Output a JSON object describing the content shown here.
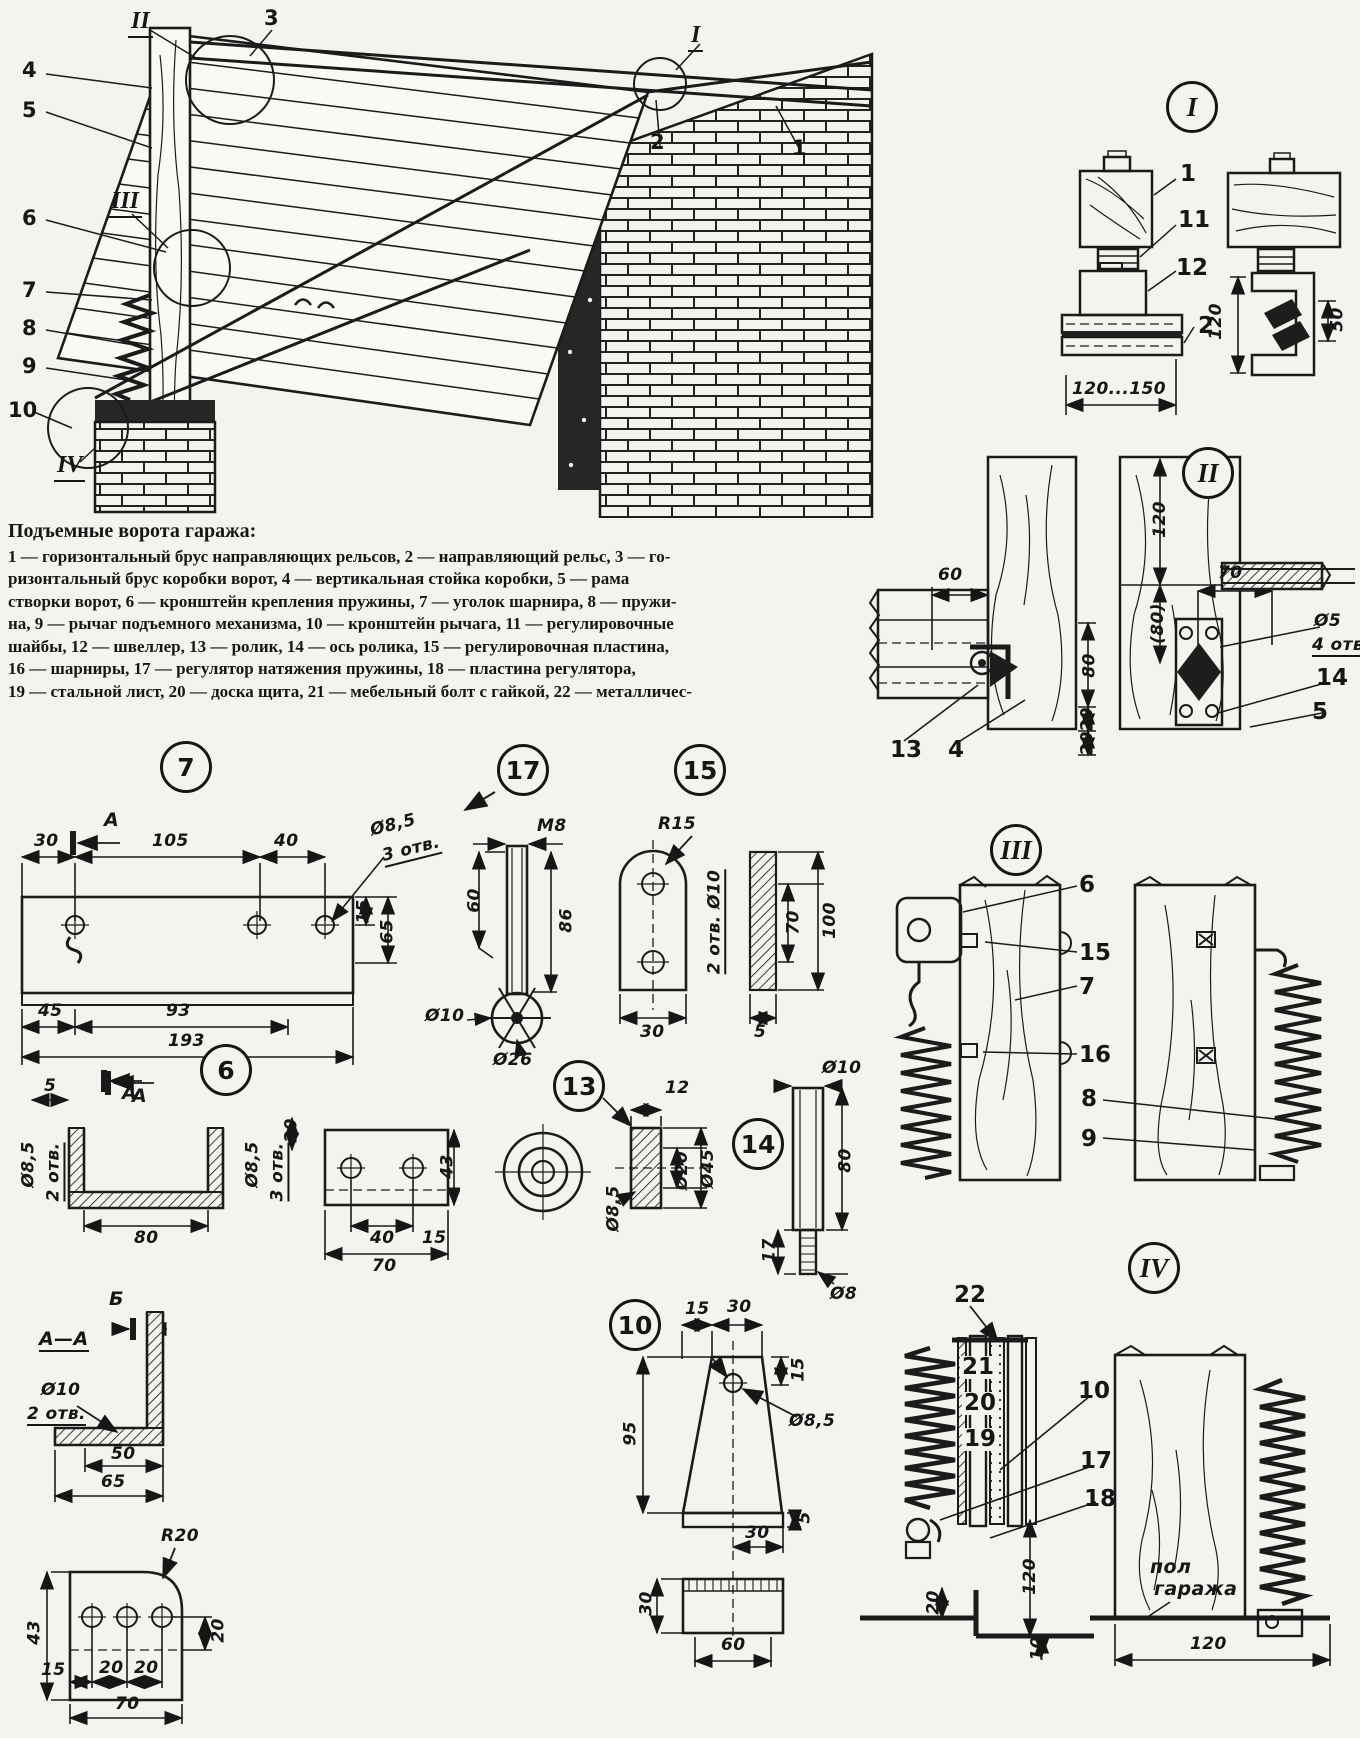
{
  "caption": {
    "title": "Подъемные ворота гаража:",
    "lines": [
      "1 — горизонтальный брус направляющих рельсов, 2 — направляющий рельс, 3 — го-",
      "ризонтальный брус коробки ворот, 4 — вертикальная стойка коробки, 5 — рама",
      "створки ворот, 6 — кронштейн крепления пружины, 7 — уголок шарнира, 8 — пружи-",
      "на, 9 — рычаг подъемного механизма, 10 — кронштейн рычага, 11 — регулировочные",
      "шайбы, 12 — швеллер, 13 — ролик, 14 — ось ролика, 15 — регулировочная пластина,",
      "16 — шарниры, 17 — регулятор натяжения пружины, 18 — пластина регулятора,",
      "19 — стальной лист, 20 — доска щита, 21 — мебельный болт с гайкой, 22 — металличес-"
    ]
  },
  "main": {
    "c_II": "II",
    "c_3": "3",
    "c_4": "4",
    "c_5": "5",
    "c_6": "6",
    "c_7": "7",
    "c_8": "8",
    "c_9": "9",
    "c_10": "10",
    "c_III": "III",
    "c_IV": "IV",
    "c_2": "2",
    "c_1": "1",
    "c_I": "I"
  },
  "dI": {
    "badge": "I",
    "p1": "1",
    "p11": "11",
    "p12": "12",
    "p2": "2",
    "dspan": "120...150",
    "d120": "120",
    "d50": "50"
  },
  "dII": {
    "badge": "II",
    "d60": "60",
    "d80": "80",
    "d20a": "20",
    "d20b": "20",
    "d120": "120",
    "d80p": "(80)",
    "d70": "70",
    "dphi5": "Ø5",
    "d4otv": "4 отв.",
    "p13": "13",
    "p4": "4",
    "p14": "14",
    "p5": "5"
  },
  "p7": {
    "badge": "7",
    "secA": "А",
    "secA2": "А",
    "d30": "30",
    "d105": "105",
    "d40": "40",
    "dphi": "Ø8,5",
    "dotv": "3 отв.",
    "d15": "15",
    "d65": "65",
    "d45": "45",
    "d93": "93",
    "d193": "193"
  },
  "p6": {
    "badge": "6",
    "d5": "5",
    "secA": "А",
    "d20": "20",
    "d80": "80",
    "dphiL": "Ø8,5",
    "dotvL": "2 отв.",
    "dphiR": "Ø8,5",
    "dotvR": "3 отв.",
    "d43": "43",
    "d40": "40",
    "d70": "70",
    "d15": "15"
  },
  "p17": {
    "badge": "17",
    "m8": "М8",
    "d60": "60",
    "d86": "86",
    "dphi10": "Ø10",
    "dphi26": "Ø26"
  },
  "p15": {
    "badge": "15",
    "r15": "R15",
    "dotv": "2 отв. Ø10",
    "d70": "70",
    "d100": "100",
    "d30": "30",
    "d5": "5"
  },
  "p13": {
    "badge": "13",
    "d12": "12",
    "dphi85": "Ø8,5",
    "dphi20": "Ø20",
    "dphi45": "Ø45"
  },
  "p14": {
    "badge": "14",
    "dphi10": "Ø10",
    "d80": "80",
    "d17": "17",
    "dphi8": "Ø8"
  },
  "dIII": {
    "badge": "III",
    "p6": "6",
    "p15": "15",
    "p7": "7",
    "p16": "16",
    "p8": "8",
    "p9": "9"
  },
  "aa": {
    "title": "А—А",
    "b": "Б",
    "dphi10": "Ø10",
    "dotv": "2 отв.",
    "d50": "50",
    "d65": "65"
  },
  "br": {
    "r20": "R20",
    "d43": "43",
    "d20": "20",
    "d15": "15",
    "d20a": "20",
    "d20b": "20",
    "d70": "70"
  },
  "p10": {
    "badge": "10",
    "d15": "15",
    "d30": "30",
    "d15r": "15",
    "dphi85": "Ø8,5",
    "d95": "95",
    "d30b": "30",
    "d5": "5",
    "d30c": "30",
    "d60": "60"
  },
  "dIV": {
    "badge": "IV",
    "p22": "22",
    "p21": "21",
    "p20": "20",
    "p19": "19",
    "p10": "10",
    "p17": "17",
    "p18": "18",
    "d20": "20",
    "d120": "120",
    "d10": "10",
    "floor": "пол",
    "floor2": "гаража",
    "d120b": "120"
  }
}
